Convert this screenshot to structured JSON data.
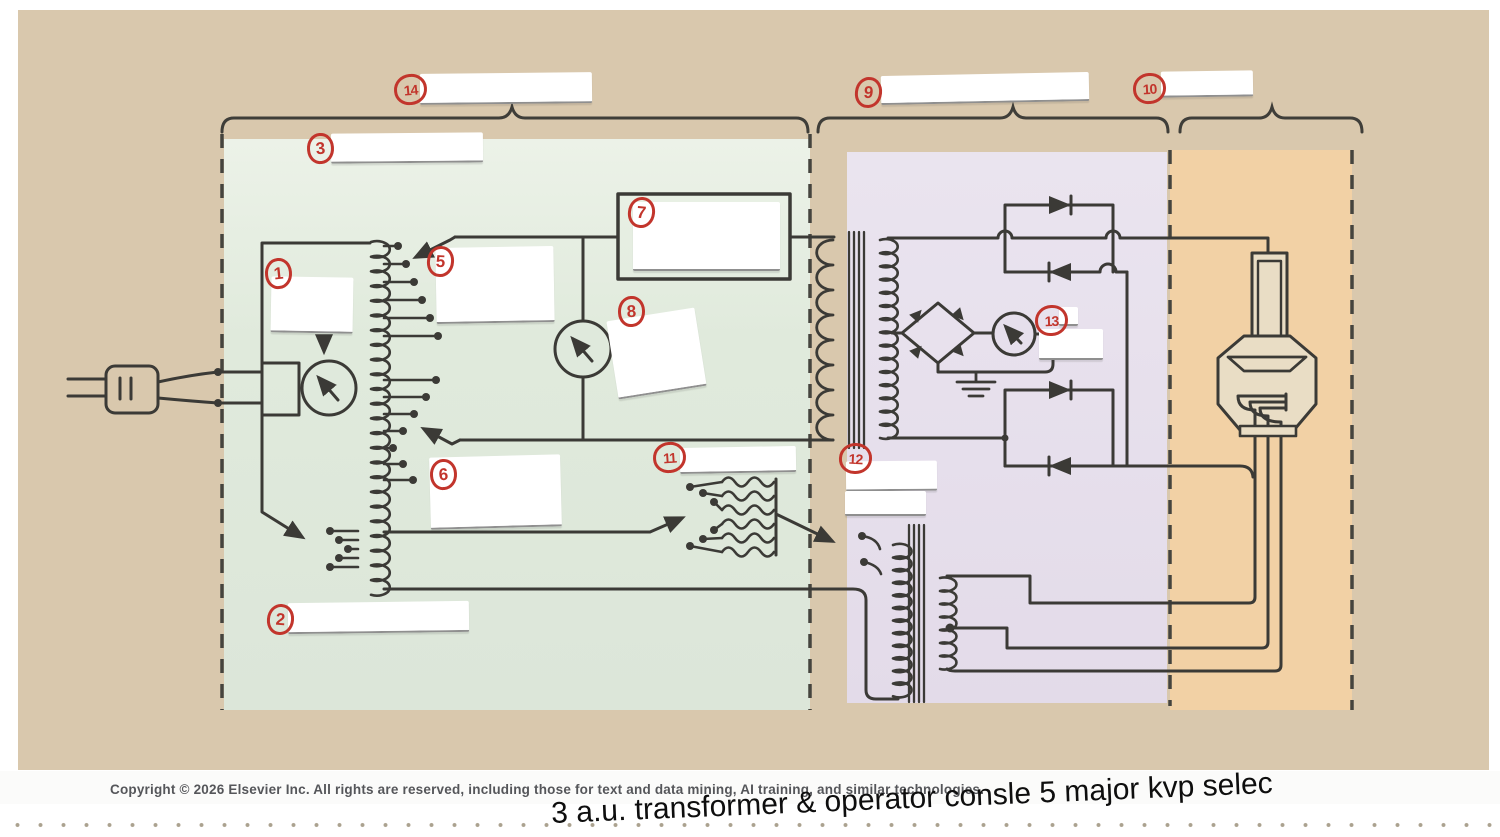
{
  "annotations": {
    "n1": "1",
    "n2": "2",
    "n3": "3",
    "n5": "5",
    "n6": "6",
    "n7": "7",
    "n8": "8",
    "n9": "9",
    "n10": "10",
    "n11": "11",
    "n12": "12",
    "n13": "13",
    "n14": "14"
  },
  "footer": {
    "copyright": "Copyright © 2026 Elsevier Inc. All rights are reserved, including those for text and data mining, AI training, and similar technologies."
  },
  "handwriting": {
    "text": "3 a.u. transformer & operator consle  5 major kvp selec"
  },
  "colors": {
    "canvas_tan": "#d9c8ad",
    "region_primary_green": "#dfe9dc",
    "region_secondary_purple": "#e6dfec",
    "region_tube_orange": "#f2d1a5",
    "annotation_red": "#c2352c",
    "wire_dark": "#3b3a36",
    "copyright_gray": "#55565a"
  },
  "icons": {
    "power_plug": "power-plug-icon",
    "autotransformer": "autotransformer-coil",
    "meter": "meter-dial-with-needle",
    "rheostat": "zigzag-resistor-bank",
    "transformer": "coil-core-coil",
    "diode": "triangle-bar-diode",
    "ground": "earth-ground",
    "xray_tube": "x-ray-tube"
  }
}
